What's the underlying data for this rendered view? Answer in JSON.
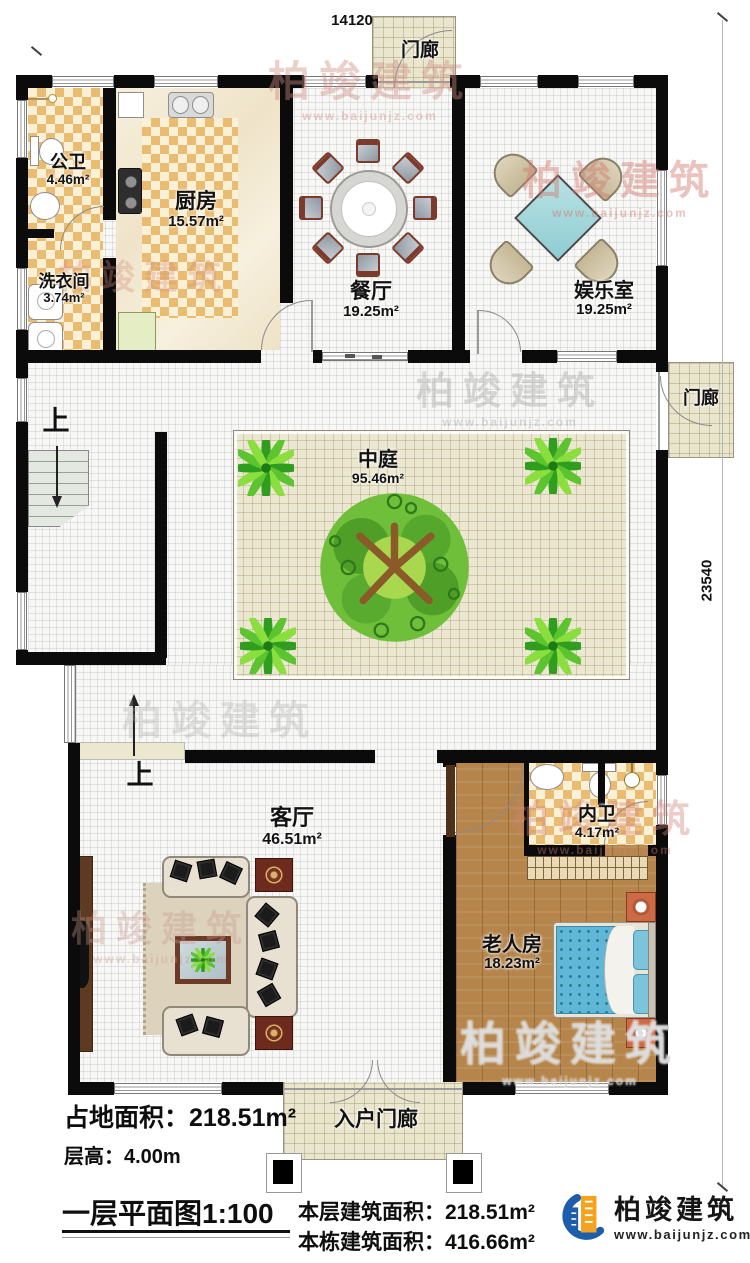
{
  "plan": {
    "scale_title": "一层平面图1:100",
    "dim_width": "14120",
    "dim_height": "23540",
    "up_label": "上",
    "rooms": {
      "gongwei": {
        "name": "公卫",
        "area": "4.46m²"
      },
      "chufang": {
        "name": "厨房",
        "area": "15.57m²"
      },
      "xiyijian": {
        "name": "洗衣间",
        "area": "3.74m²"
      },
      "canting": {
        "name": "餐厅",
        "area": "19.25m²"
      },
      "yuleshi": {
        "name": "娱乐室",
        "area": "19.25m²"
      },
      "zhongting": {
        "name": "中庭",
        "area": "95.46m²"
      },
      "keting": {
        "name": "客厅",
        "area": "46.51m²"
      },
      "neiwei": {
        "name": "内卫",
        "area": "4.17m²"
      },
      "laorenfang": {
        "name": "老人房",
        "area": "18.23m²"
      },
      "menlang_top": {
        "name": "门廊"
      },
      "menlang_right": {
        "name": "门廊"
      },
      "ruhu_menlang": {
        "name": "入户门廊"
      }
    },
    "stats": {
      "footprint_label": "占地面积：",
      "footprint_value": "218.51m²",
      "floor_height_label": "层高：",
      "floor_height_value": "4.00m",
      "floor_area_label": "本层建筑面积：",
      "floor_area_value": "218.51m²",
      "building_area_label": "本栋建筑面积：",
      "building_area_value": "416.66m²"
    }
  },
  "branding": {
    "company": "柏竣建筑",
    "website": "www.baijunjz.com"
  },
  "colors": {
    "wall": "#0b0b0b",
    "porch_floor": "#eae5cd",
    "courtyard_floor": "#ece7d1",
    "tile_orange": "#eabc72",
    "wood_floor": "#b5854c",
    "bed_blue": "#5fb6d6",
    "table_cyan": "#9dd4d8",
    "logo_blue": "#1d5dab",
    "logo_orange": "#f5a31c"
  }
}
